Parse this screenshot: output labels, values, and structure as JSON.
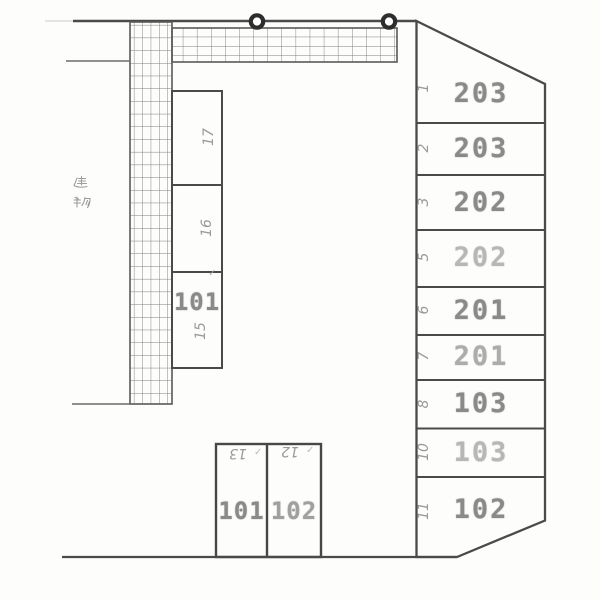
{
  "building": {
    "label": "建物"
  },
  "parking": {
    "right_column": [
      {
        "no": "1",
        "room": "203"
      },
      {
        "no": "2",
        "room": "203"
      },
      {
        "no": "3",
        "room": "202"
      },
      {
        "no": "5",
        "room": "202"
      },
      {
        "no": "6",
        "room": "201"
      },
      {
        "no": "7",
        "room": "201"
      },
      {
        "no": "8",
        "room": "103"
      },
      {
        "no": "10",
        "room": "103"
      },
      {
        "no": "11",
        "room": "102"
      }
    ],
    "middle_column": [
      {
        "no": "17",
        "room": ""
      },
      {
        "no": "16",
        "room": ""
      },
      {
        "no": "15",
        "room": "101"
      }
    ],
    "bottom_row": [
      {
        "no": "13",
        "room": "101"
      },
      {
        "no": "12",
        "room": "102"
      }
    ]
  },
  "marks": {
    "check": "✓"
  },
  "colors": {
    "ink": "#4a4a4a",
    "hatch": "#7a7a7a",
    "stamp": "#8a8a8a",
    "pencil": "#8f8f8f",
    "paper": "#fdfdfb"
  }
}
